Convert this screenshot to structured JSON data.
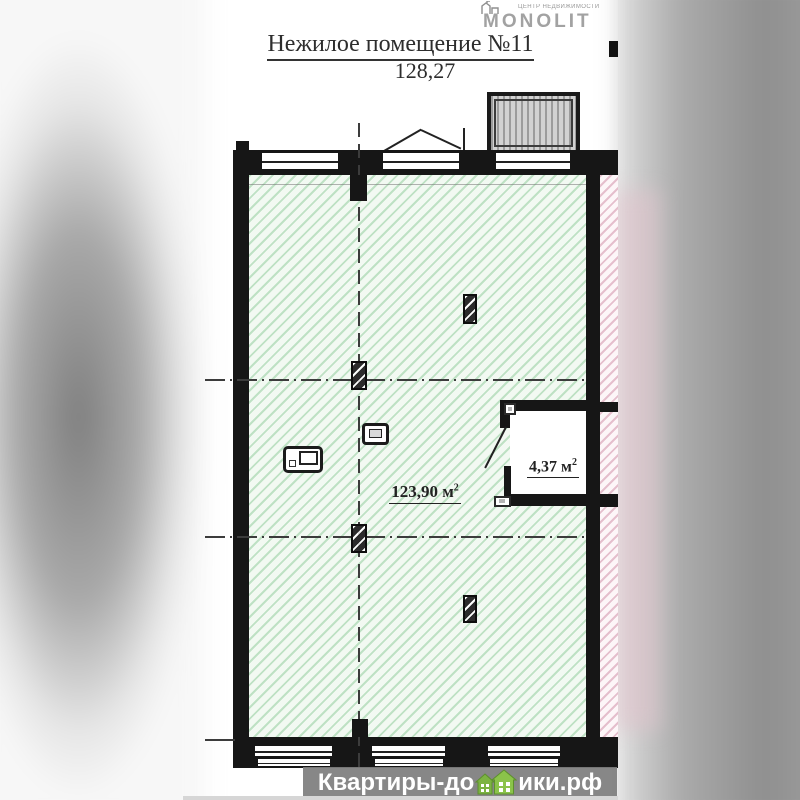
{
  "brand": {
    "tagline": "ЦЕНТР НЕДВИЖИМОСТИ",
    "name": "MONOLIT"
  },
  "header": {
    "title": "Нежилое помещение №11",
    "total_area": "128,27"
  },
  "plan": {
    "main_room_area": "123,90 м",
    "main_room_area_sup": "2",
    "storage_area": "4,37 м",
    "storage_area_sup": "2"
  },
  "watermark": {
    "text_left": "Квартиры-до",
    "text_right": "ики.рф"
  },
  "colors": {
    "wall": "#161616",
    "hatch_green": "#94cd9e",
    "hatch_pink": "#dba8bb",
    "logo_gray": "#a2a2a2",
    "watermark_band": "#7e7e7e",
    "watermark_house_green": "#7cb342"
  }
}
